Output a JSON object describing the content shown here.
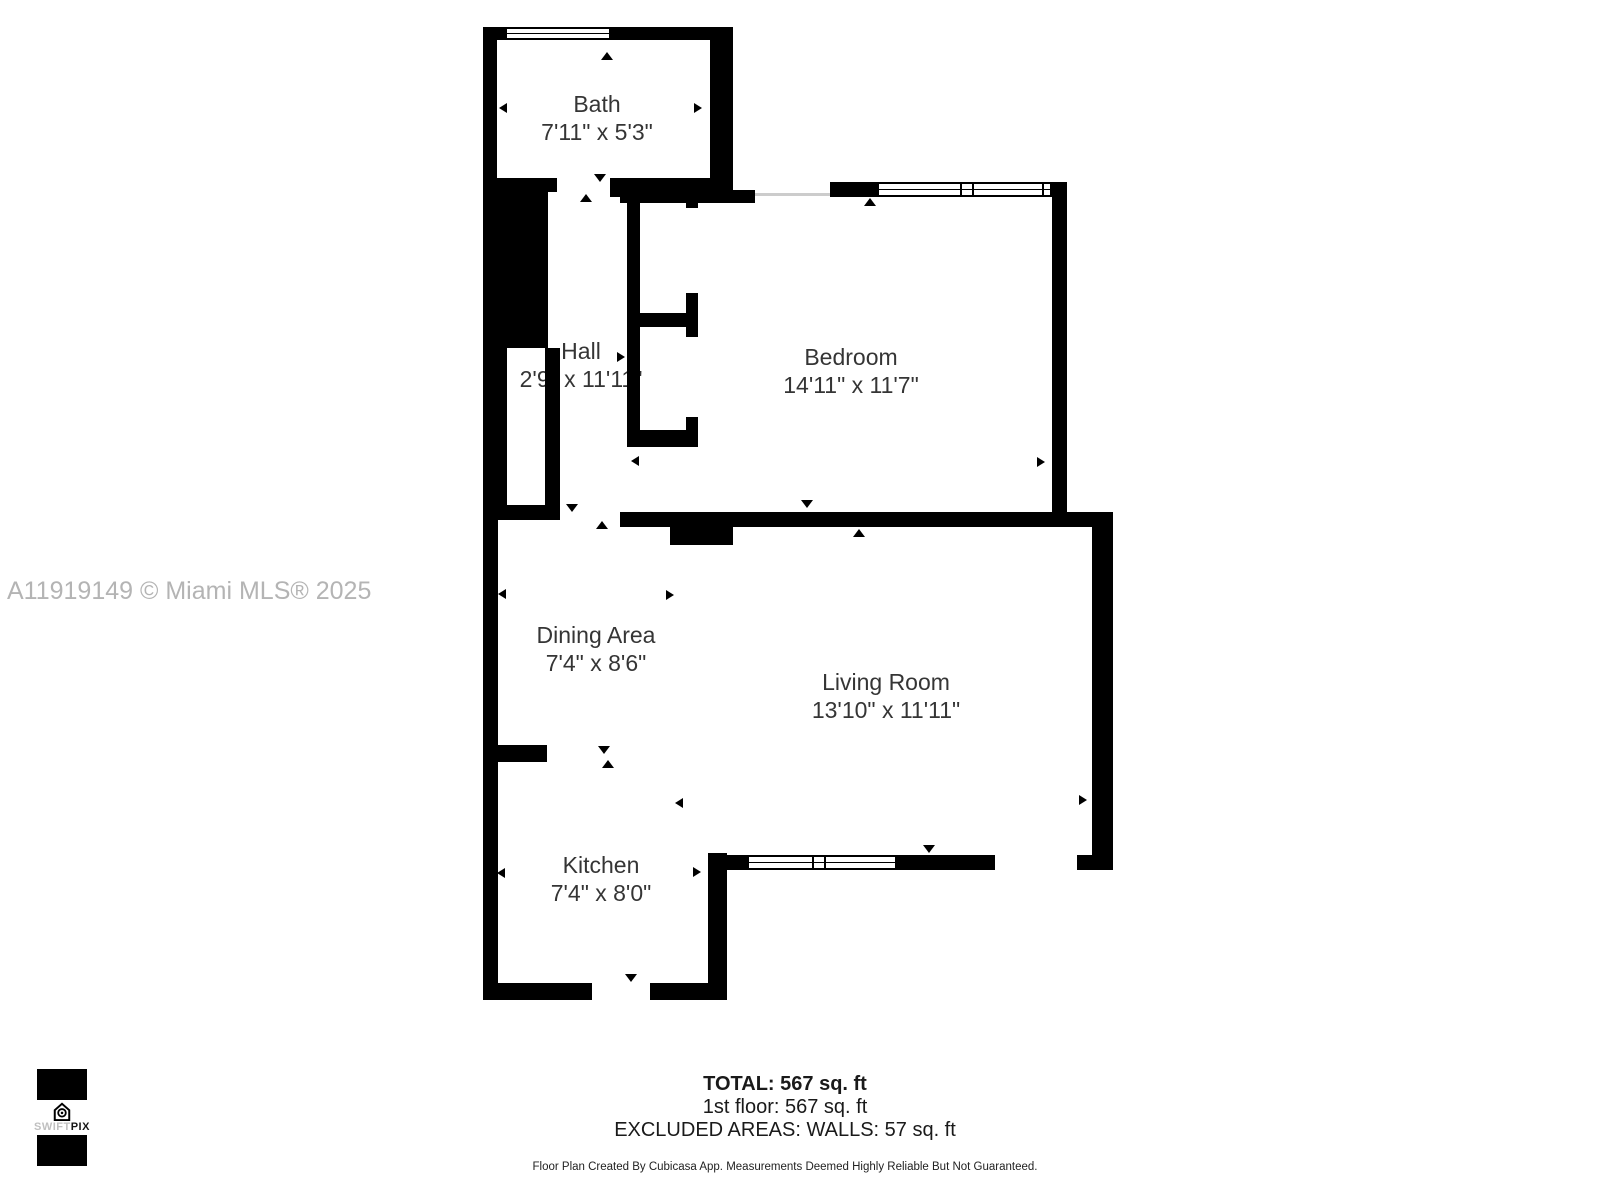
{
  "watermark": {
    "text": "A11919149 © Miami MLS® 2025"
  },
  "rooms": [
    {
      "name": "Bath",
      "dims": "7'11\" x 5'3\""
    },
    {
      "name": "Hall",
      "dims": "2'9\" x 11'11\""
    },
    {
      "name": "Bedroom",
      "dims": "14'11\" x 11'7\""
    },
    {
      "name": "Dining Area",
      "dims": "7'4\" x 8'6\""
    },
    {
      "name": "Living Room",
      "dims": "13'10\" x 11'11\""
    },
    {
      "name": "Kitchen",
      "dims": "7'4\" x 8'0\""
    }
  ],
  "summary": {
    "total": "TOTAL: 567 sq. ft",
    "floor1": "1st floor: 567 sq. ft",
    "excluded": "EXCLUDED AREAS: WALLS: 57 sq. ft",
    "disclaimer": "Floor Plan Created By Cubicasa App. Measurements Deemed Highly Reliable But Not Guaranteed."
  },
  "logo": {
    "swift": "SWIFT",
    "pix": "PIX"
  },
  "colors": {
    "walls": "#000000",
    "label_text": "#353535",
    "watermark": "#b4b4b4",
    "opening_line": "#cccccc"
  }
}
